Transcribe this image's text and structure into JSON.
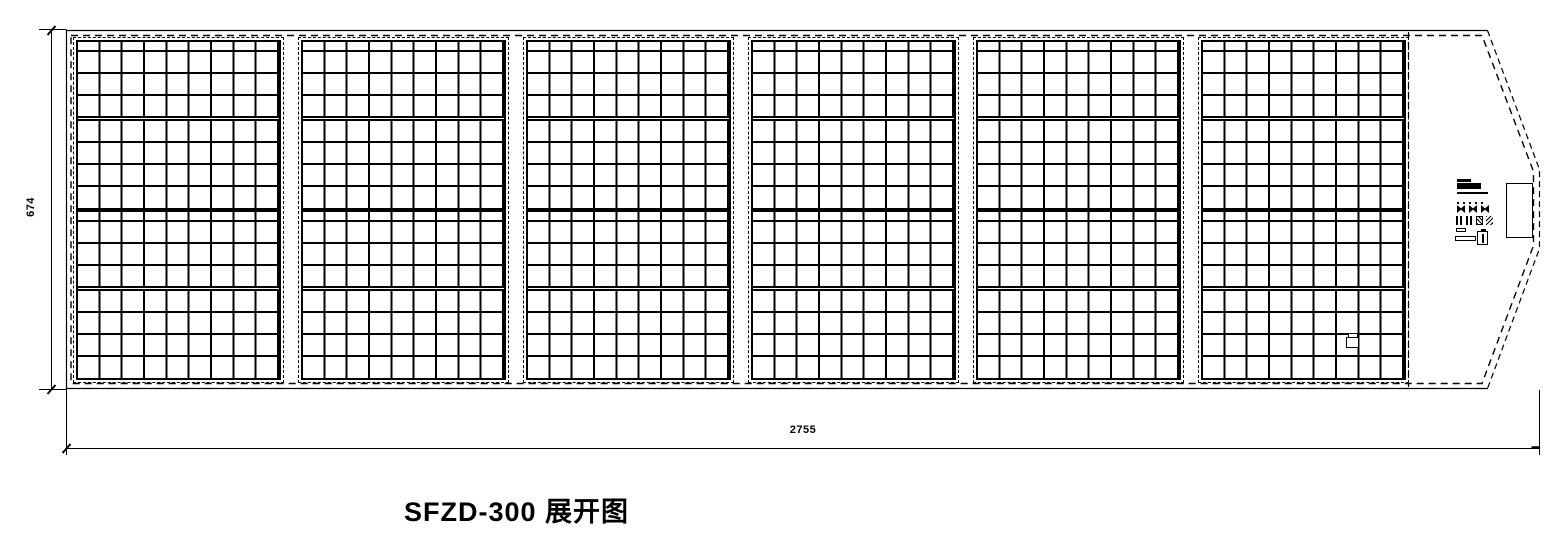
{
  "title": "SFZD-300 展开图",
  "dimensions": {
    "width": "2755",
    "height": "674"
  },
  "panel_grid": {
    "count": 6,
    "columns": 9,
    "half_rows": [
      10,
      22,
      22,
      22,
      "sep",
      22,
      22,
      22,
      "fill"
    ]
  },
  "flap_print": {
    "icons": [
      "logo-mark",
      "care-instruction-icons",
      "certification-marks",
      "weee-bin"
    ]
  },
  "colors": {
    "line": "#000000",
    "background": "#ffffff"
  }
}
